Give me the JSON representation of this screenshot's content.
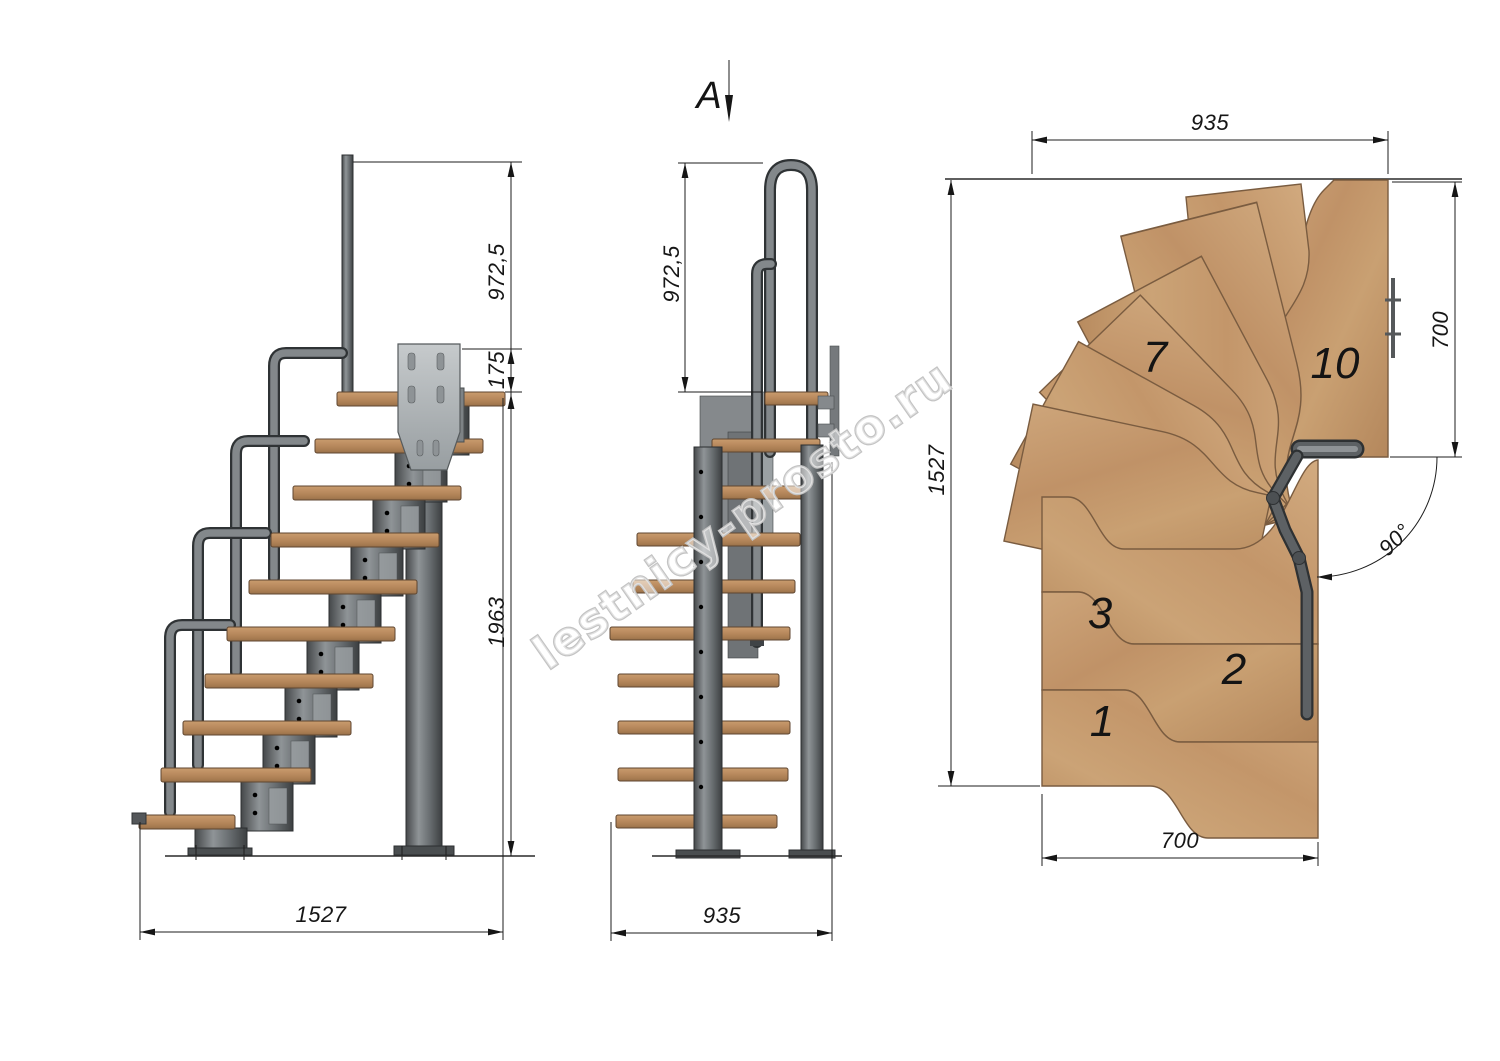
{
  "watermark": {
    "text": "lestnicy-prosto.ru"
  },
  "section_marker": {
    "label": "A"
  },
  "side_view": {
    "dim_rail_height": "972,5",
    "dim_landing_rise": "175",
    "dim_lower_height": "1963",
    "dim_length": "1527"
  },
  "front_view": {
    "dim_rail_height": "972,5",
    "dim_width": "935"
  },
  "plan_view": {
    "dim_width_top": "935",
    "dim_depth_left": "1527",
    "dim_landing_right": "700",
    "dim_run_bottom": "700",
    "dim_turn_angle": "90°",
    "steps": {
      "s1": "1",
      "s2": "2",
      "s3": "3",
      "s7": "7",
      "s10": "10"
    }
  },
  "colors": {
    "background": "#ffffff",
    "line": "#2a2a2a",
    "wood_side": "#b98a5e",
    "wood_plan": "#c49a6d",
    "metal_dark": "#4a4e50",
    "metal_light": "#9ba0a3",
    "watermark_stroke": "#c3c3c3"
  }
}
